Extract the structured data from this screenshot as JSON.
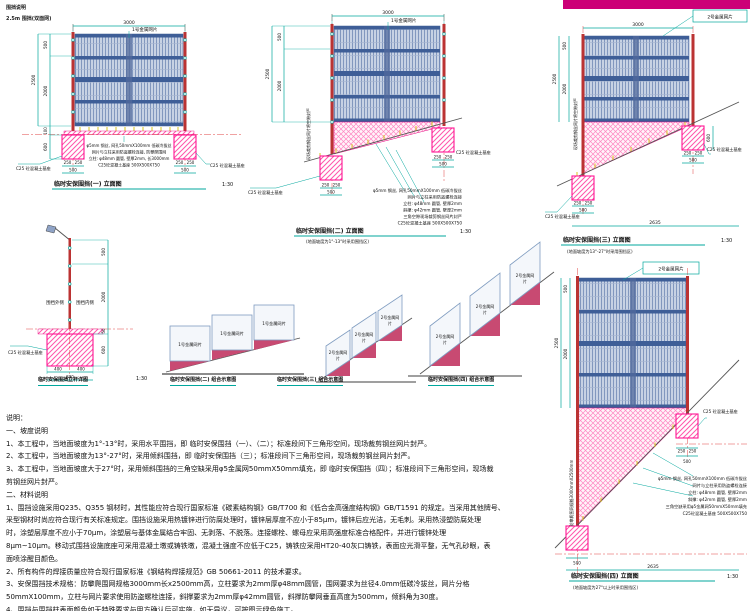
{
  "header": {
    "line1": "围挡说明",
    "line2": "2.5m 围挡(双面网)"
  },
  "d1": {
    "title": "临时安保围挡(一) 立面图",
    "scale": "1:30",
    "mesh_label": "1号金属网片",
    "dims": {
      "top": "3000",
      "total": "2500",
      "seg1": "500",
      "seg2": "2000",
      "gap": "100",
      "foot": "600",
      "fw": "250",
      "fww": "500"
    },
    "callout_left": "C25 砼混凝土基座",
    "callout_right": "C25 砼混凝土基座",
    "spec_lines": [
      "φ5mm 钢丝, 网孔50mmX100mm 低碳冷拔丝",
      "网片与立柱采用防盗螺栓连接, 防攀爬围网",
      "立柱: φ48mm 圆管, 壁厚2mm, 长3000mm",
      "C25砼混凝土基座 500X500X750"
    ]
  },
  "d2": {
    "title": "临时安保围挡(二) 立面图",
    "scale": "1:30",
    "subtitle": "(地面坡度为1°-13°时采用围挡区)",
    "mesh_label": "1号金属网片",
    "rot_note": "现场裁剪钢丝网片将空隙封严",
    "dims": {
      "top": "3000",
      "total": "2500",
      "seg1": "500",
      "seg2": "2000",
      "fw": "250",
      "fww": "500"
    },
    "callout_left": "C25 砼混凝土基座",
    "callout_right": "C25 砼混凝土基座",
    "spec_lines": [
      "φ5mm 钢丝, 网孔50mmX100mm 低碳冷拔丝",
      "网片与立柱采用防盗螺栓连接",
      "立柱: φ48mm 圆管, 壁厚2mm",
      "斜撑: φ42mm 圆管, 壁厚2mm",
      "三角空隙现场裁剪钢丝网片封严",
      "C25砼混凝土基座 500X500X750"
    ]
  },
  "d3": {
    "title": "临时安保围挡(三) 立面图",
    "scale": "1:30",
    "subtitle": "(地面坡度为13°-27°时采用围挡区)",
    "box_label": "2号金属网片",
    "rot_note": "现场裁剪钢丝网片将空隙封严",
    "dims": {
      "top": "3000",
      "total": "2500",
      "seg1": "500",
      "seg2": "2000",
      "foot": "600",
      "fw": "250",
      "fww": "500",
      "bottom": "2635"
    },
    "callout_left": "C25 砼混凝土基座",
    "callout_right": "C25 砼混凝土基座"
  },
  "d4": {
    "title": "临时安保围挡(四) 立面图",
    "scale": "1:30",
    "subtitle": "(地面坡度为27°以上时采用围挡区)",
    "box_label": "2号金属网片",
    "rot_note": "防攀爬围网规格3000mmX2500mm",
    "dims": {
      "total": "2500",
      "seg1": "500",
      "seg2": "2000",
      "fw": "250",
      "fww": "500",
      "bottom": "2635"
    },
    "callout_right": "C25 砼混凝土基座",
    "spec_lines": [
      "φ5mm 钢丝, 网孔50mmX100mm 低碳冷拔丝",
      "网片与立柱采用防盗螺栓连接",
      "立柱: φ48mm 圆管, 壁厚2mm",
      "斜撑: φ42mm 圆管, 壁厚2mm",
      "三角空缺采用φ5金属网50mmX50mm填充",
      "C25砼混凝土基座 500X500X750"
    ]
  },
  "pole": {
    "caption": "临时安保围挡立杆详图",
    "scale": "1:30",
    "side_out": "围挡外侧",
    "side_in": "围挡内侧",
    "callout": "C25 砼混凝土基座",
    "dims": {
      "seg1": "500",
      "seg2": "2000",
      "seg3": "50",
      "foot": "600",
      "w": "400",
      "ww": "800"
    }
  },
  "combo2": {
    "caption": "临时安保围挡(二) 组合示意图",
    "panel_label": "1号金属网片"
  },
  "combo3": {
    "caption": "临时安保围挡(三) 组合示意图",
    "label_a": "2号金属网",
    "label_b": "片"
  },
  "combo4": {
    "caption": "临时安保围挡(四) 组合示意图",
    "label_a": "2号金属网",
    "label_b": "片"
  },
  "notes": {
    "lines": [
      "说明：",
      "一、坡度说明",
      "1、本工程中，当地面坡度为1°-13°时，采用水平围挡，即 临时安保围挡（一）、（二）；标准段间下三角形空间，现场裁剪钢丝网片封严。",
      "2、本工程中，当地面坡度为13°-27°时，采用倾斜围挡，即 临时安保围挡（三）；标准段间下三角形空间，现场裁剪钢丝网片封严。",
      "3、本工程中，当地面坡度大于27°时，采用倾斜围挡的三角空缺采用φ5金属网50mmX50mm填充，即 临时安保围挡（四）；标准段间下三角形空间，现场裁",
      "剪钢丝网片封严。",
      "二、材料说明",
      "1、围挡设施采用Q235、Q355 钢材时，其性能应符合现行国家标准《碳素结构钢》GB/T700 和《低合金高强度结构钢》GB/T1591 的规定。当采用其他牌号、",
      "采型钢材时尚应符合现行有关标准规定。围挡设施采用热镀锌进行防腐处理时，镀锌层厚度不应小于85μm，镀锌后应光洁，无毛刺。采用热浸塑防腐处理",
      "时，涂塑层厚度不应小于70μm，涂塑层与基体金属结合牢固、无剥落、不脱落。连接螺栓、螺母应采用高强度标准合格配件，并进行镀锌处理",
      "8μm~10μm。移动式围挡设施底座可采用混凝土墩或铸铁墩，混凝土强度不应低于C25，铸铁应采用HT20-40灰口铸铁，表面应光滑平整，无气孔砂眼，表",
      "面喷涂醒目颜色。",
      "2、所有构件的焊接质量应符合现行国家标准《钢结构焊接规范》GB 50661-2011 的技术要求。",
      "3、安保围挡技术规格：防攀爬围网规格3000mm长x2500mm高，立柱要求为2mm厚φ48mm圆管，围网要求为丝径4.0mm低碳冷拔丝，网片分格",
      "50mmX100mm，立柱与网片要求使用防盗螺栓连接，斜撑要求为2mm厚φ42mm圆管，斜撑防攀网垂直高度为500mm，倾斜角为30度。",
      "4、围挡与围挡柱表面颜色如无特殊要求与甲方确认后可实施，如无异议，可按图示绿色施工。"
    ]
  }
}
